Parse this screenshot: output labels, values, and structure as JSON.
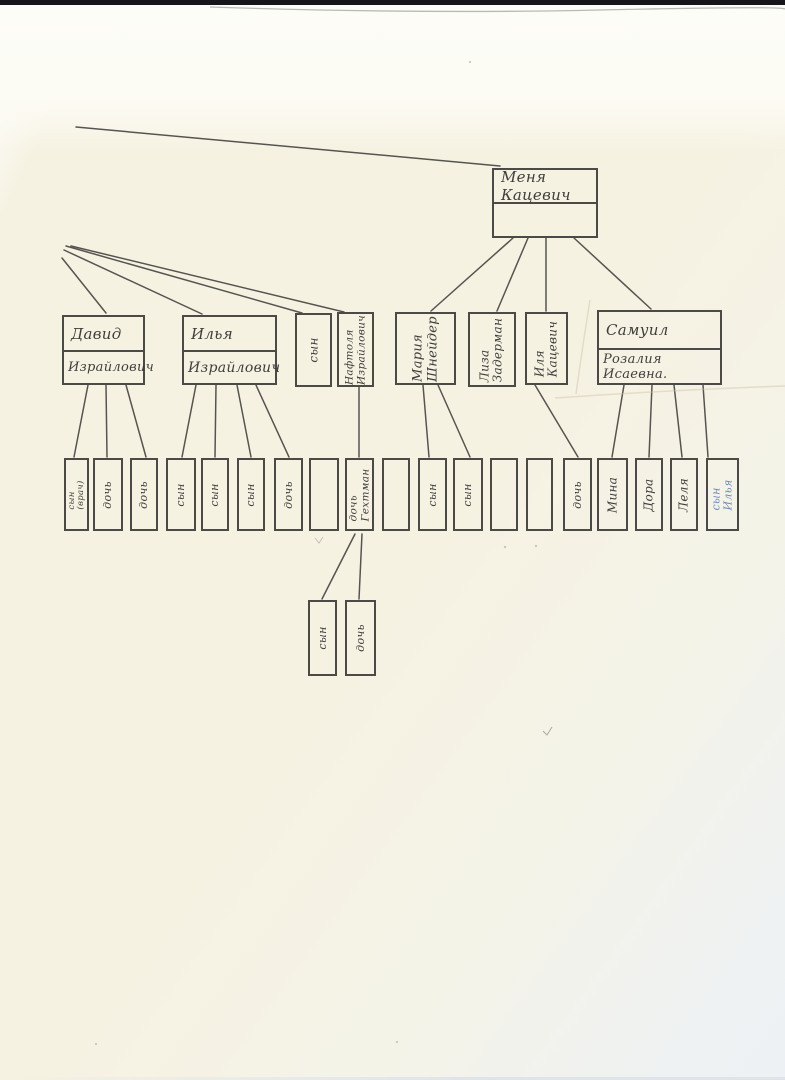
{
  "colors": {
    "ink": "#3f3e3c",
    "blue_ink": "#4a6fb5",
    "box_border": "#4c4a46",
    "paper": "#f6f2e2",
    "top_strip": "#15151b"
  },
  "tree": {
    "root": {
      "name": "Меня Кацевич"
    },
    "g2": [
      {
        "line1": "Давид",
        "line2": "Израйлович"
      },
      {
        "line1": "Илья",
        "line2": "Израйлович"
      },
      {
        "line1": "сын",
        "line2": ""
      },
      {
        "line1": "Нафтоля",
        "line2": "Израйлович"
      },
      {
        "line1": "Мария",
        "line2": "Шнейдер"
      },
      {
        "line1": "Лиза",
        "line2": "Задерман"
      },
      {
        "line1": "Иля",
        "line2": "Кацевич"
      },
      {
        "line1": "Самуил",
        "line2": "Розалия Исаевна."
      }
    ],
    "g3": [
      {
        "line1": "сын",
        "line2": "(врач)"
      },
      {
        "line1": "дочь"
      },
      {
        "line1": "дочь"
      },
      {
        "line1": "сын"
      },
      {
        "line1": "сын"
      },
      {
        "line1": "сын"
      },
      {
        "line1": "дочь"
      },
      {
        "line1": ""
      },
      {
        "line1": "дочь",
        "line2": "Гехтман"
      },
      {
        "line1": ""
      },
      {
        "line1": "сын"
      },
      {
        "line1": "сын"
      },
      {
        "line1": ""
      },
      {
        "line1": ""
      },
      {
        "line1": "дочь"
      },
      {
        "line1": "Мина"
      },
      {
        "line1": "Дора"
      },
      {
        "line1": "Леля"
      },
      {
        "line1": "сын",
        "line2": "Илья",
        "ink": "blue"
      }
    ],
    "g4": [
      {
        "line1": "сын"
      },
      {
        "line1": "дочь"
      }
    ]
  }
}
